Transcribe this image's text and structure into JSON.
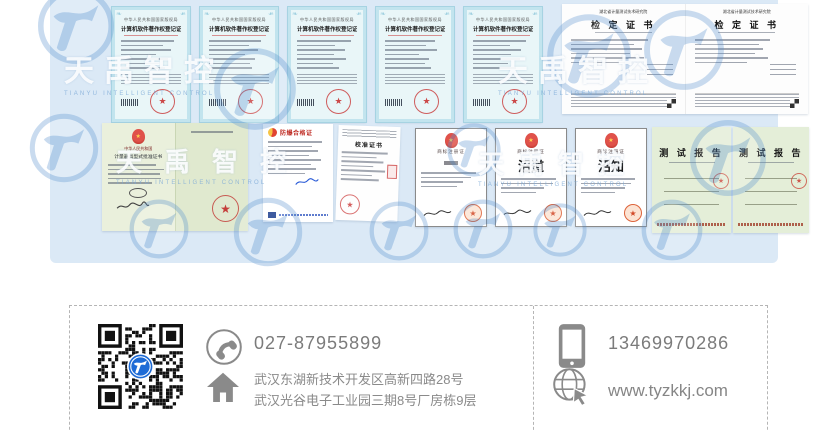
{
  "brand": {
    "watermark_text": "天禹智控",
    "watermark_subtitle": "TIANYU INTELLIGENT CONTROL"
  },
  "certificates": {
    "copyright": {
      "authority": "中华人民共和国国家版权局",
      "title": "计算机软件著作权登记证书"
    },
    "verification": {
      "institute": "湖北省计量测试技术研究院",
      "title": "检 定 证 书"
    },
    "type_approval": {
      "country": "中华人民共和国",
      "title": "计量器具型式批准证书"
    },
    "explosion": {
      "title": "防爆合格证"
    },
    "calibration": {
      "title": "校准证书"
    },
    "trademark": {
      "title": "商标注册证",
      "mark2": "沼道",
      "mark3": "沼知"
    },
    "test_report": {
      "title": "测 试 报 告"
    }
  },
  "contact": {
    "phone": "027-87955899",
    "mobile": "13469970286",
    "website": "www.tyzkkj.com",
    "address_line1": "武汉东湖新技术开发区高新四路28号",
    "address_line2": "武汉光谷电子工业园三期8号厂房栋9层"
  },
  "icons": {
    "qr": "qr-code",
    "phone": "phone-icon",
    "address": "home-icon",
    "mobile": "mobile-icon",
    "website": "globe-icon",
    "watermark": "tianyu-logo-icon"
  },
  "colors": {
    "panel_bg": "#dbe9f6",
    "watermark_blue": "#5b93cf",
    "qr_logo_blue": "#1e6bd6",
    "seal_red": "#c62828",
    "contact_text_gray": "#7b7b7b"
  }
}
